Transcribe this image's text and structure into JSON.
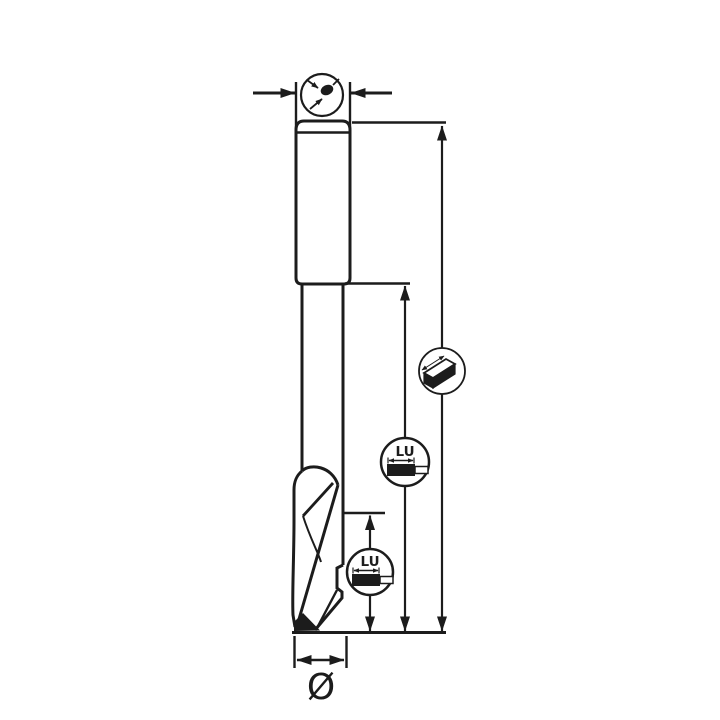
{
  "drawing": {
    "subject": "single-flute spiral router bit side view with dimension callouts",
    "background_color": "#ffffff",
    "line_color": "#1c1c1c",
    "labels": {
      "lu": "LU",
      "diameter": "Ø"
    },
    "icons": {
      "shank_diameter": "shank-cross-section-dot-with-measuring-arrows",
      "panel_board": "panel-board-3d-with-length-arrow",
      "cutting_length_upper": "LU-cutting-length-profile",
      "cutting_length_lower": "LU-cutting-length-profile",
      "tip_diameter": "diameter-symbol"
    },
    "dimensions": {
      "top": "shank diameter (inward arrows at shank top)",
      "right_outer": "overall length (full tool height)",
      "right_middle": "length below shank",
      "right_inner": "cutting edge length LU",
      "bottom": "cutting diameter Ø"
    }
  }
}
